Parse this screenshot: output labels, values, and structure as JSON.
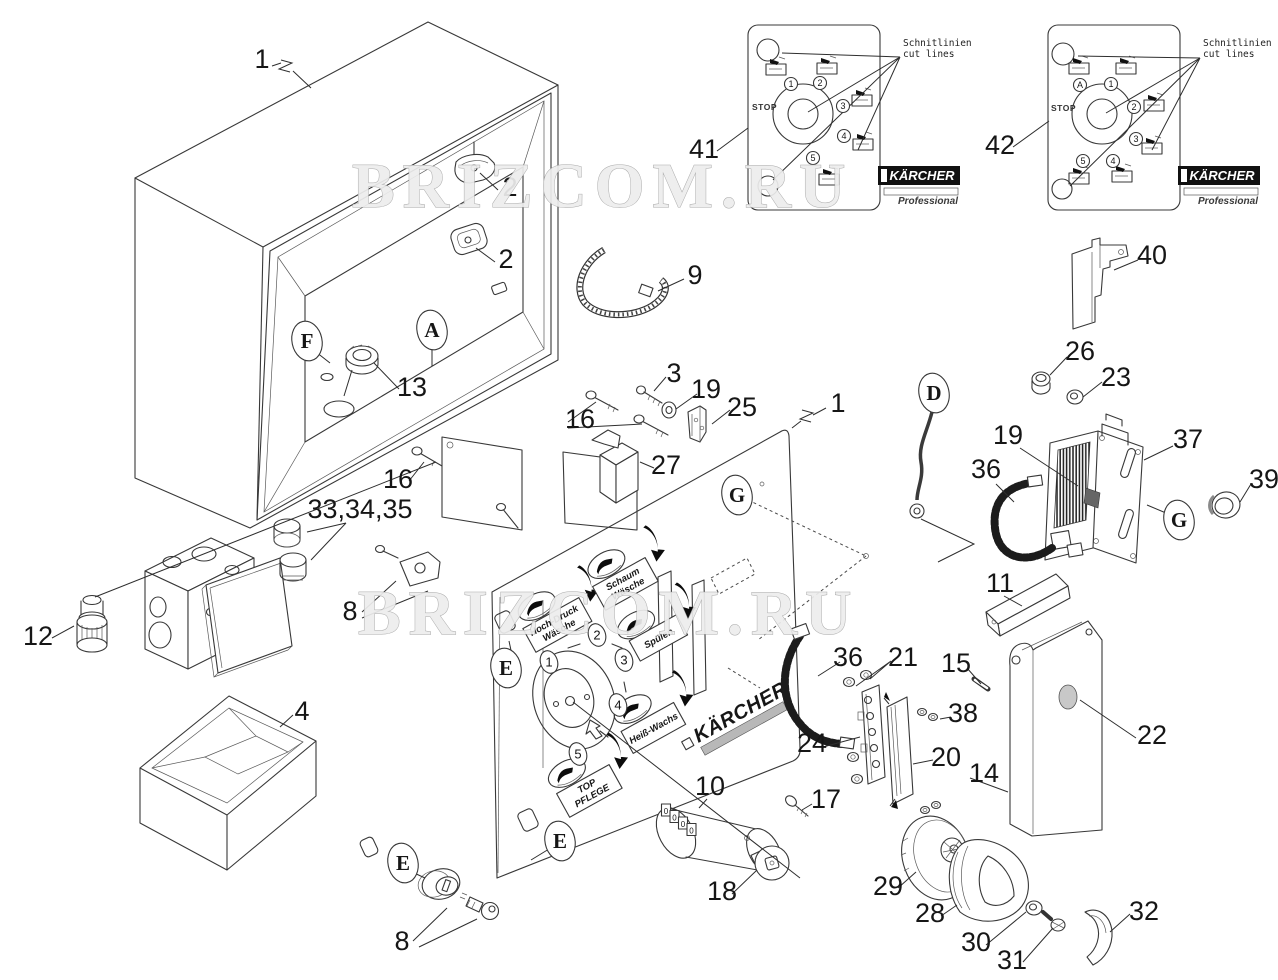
{
  "watermark": {
    "text": "BRIZCOM.RU",
    "instances": [
      {
        "x": 352,
        "y": 207
      },
      {
        "x": 358,
        "y": 634
      }
    ]
  },
  "callouts": [
    {
      "t": "1",
      "x": 262,
      "y": 68
    },
    {
      "t": "2",
      "x": 510,
      "y": 196
    },
    {
      "t": "2",
      "x": 506,
      "y": 268
    },
    {
      "t": "9",
      "x": 695,
      "y": 284
    },
    {
      "t": "13",
      "x": 412,
      "y": 396
    },
    {
      "t": "16",
      "x": 398,
      "y": 488
    },
    {
      "t": "33,34,35",
      "x": 360,
      "y": 518
    },
    {
      "t": "12",
      "x": 38,
      "y": 645
    },
    {
      "t": "8",
      "x": 350,
      "y": 620
    },
    {
      "t": "4",
      "x": 302,
      "y": 720
    },
    {
      "t": "16",
      "x": 580,
      "y": 428
    },
    {
      "t": "3",
      "x": 674,
      "y": 382
    },
    {
      "t": "19",
      "x": 706,
      "y": 398
    },
    {
      "t": "25",
      "x": 742,
      "y": 416
    },
    {
      "t": "27",
      "x": 666,
      "y": 474
    },
    {
      "t": "1",
      "x": 838,
      "y": 412
    },
    {
      "t": "41",
      "x": 704,
      "y": 158
    },
    {
      "t": "42",
      "x": 1000,
      "y": 154
    },
    {
      "t": "40",
      "x": 1152,
      "y": 264
    },
    {
      "t": "26",
      "x": 1080,
      "y": 360
    },
    {
      "t": "23",
      "x": 1116,
      "y": 386
    },
    {
      "t": "19",
      "x": 1008,
      "y": 444
    },
    {
      "t": "36",
      "x": 986,
      "y": 478
    },
    {
      "t": "37",
      "x": 1188,
      "y": 448
    },
    {
      "t": "39",
      "x": 1264,
      "y": 488
    },
    {
      "t": "11",
      "x": 1000,
      "y": 592
    },
    {
      "t": "15",
      "x": 956,
      "y": 672
    },
    {
      "t": "36",
      "x": 848,
      "y": 666
    },
    {
      "t": "21",
      "x": 903,
      "y": 666
    },
    {
      "t": "38",
      "x": 963,
      "y": 722
    },
    {
      "t": "24",
      "x": 812,
      "y": 752
    },
    {
      "t": "20",
      "x": 946,
      "y": 766
    },
    {
      "t": "14",
      "x": 984,
      "y": 782
    },
    {
      "t": "22",
      "x": 1152,
      "y": 744
    },
    {
      "t": "10",
      "x": 710,
      "y": 795
    },
    {
      "t": "17",
      "x": 826,
      "y": 808
    },
    {
      "t": "18",
      "x": 722,
      "y": 900
    },
    {
      "t": "29",
      "x": 888,
      "y": 895
    },
    {
      "t": "28",
      "x": 930,
      "y": 922
    },
    {
      "t": "30",
      "x": 976,
      "y": 951
    },
    {
      "t": "31",
      "x": 1012,
      "y": 969
    },
    {
      "t": "32",
      "x": 1144,
      "y": 920
    },
    {
      "t": "8",
      "x": 402,
      "y": 950
    }
  ],
  "ref_letters": [
    {
      "t": "F",
      "x": 307,
      "y": 341
    },
    {
      "t": "A",
      "x": 432,
      "y": 330
    },
    {
      "t": "D",
      "x": 934,
      "y": 393
    },
    {
      "t": "G",
      "x": 737,
      "y": 495
    },
    {
      "t": "G",
      "x": 1179,
      "y": 520
    },
    {
      "t": "E",
      "x": 506,
      "y": 668
    },
    {
      "t": "E",
      "x": 560,
      "y": 841
    },
    {
      "t": "E",
      "x": 403,
      "y": 863
    }
  ],
  "panel": {
    "brand": "KÄRCHER",
    "positions": [
      {
        "t": "1",
        "x": 549,
        "y": 662
      },
      {
        "t": "2",
        "x": 597,
        "y": 635
      },
      {
        "t": "3",
        "x": 624,
        "y": 660
      },
      {
        "t": "4",
        "x": 618,
        "y": 705
      },
      {
        "t": "5",
        "x": 578,
        "y": 754
      }
    ],
    "stickers": [
      {
        "line1": "Hoch-Druck",
        "line2": "Wäsche"
      },
      {
        "line1": "Schaum",
        "line2": "Wäsche"
      },
      {
        "line1": "Spülen",
        "line2": ""
      },
      {
        "line1": "Heiß-Wachs",
        "line2": ""
      },
      {
        "line1": "TOP",
        "line2": "PFLEGE"
      }
    ]
  },
  "decals": [
    {
      "id": "41",
      "stop": "STOP",
      "note1": "Schnitlinien",
      "note2": "cut lines",
      "brand": "KÄRCHER",
      "sub": "Professional",
      "positions": [
        {
          "t": "1",
          "x": 791,
          "y": 84
        },
        {
          "t": "2",
          "x": 820,
          "y": 83
        },
        {
          "t": "3",
          "x": 843,
          "y": 106
        },
        {
          "t": "4",
          "x": 844,
          "y": 136
        },
        {
          "t": "5",
          "x": 813,
          "y": 158
        }
      ]
    },
    {
      "id": "42",
      "stop": "STOP",
      "note1": "Schnitlinien",
      "note2": "cut lines",
      "brand": "KÄRCHER",
      "sub": "Professional",
      "positions": [
        {
          "t": "A",
          "x": 1080,
          "y": 85
        },
        {
          "t": "1",
          "x": 1111,
          "y": 84
        },
        {
          "t": "2",
          "x": 1134,
          "y": 107
        },
        {
          "t": "3",
          "x": 1136,
          "y": 139
        },
        {
          "t": "4",
          "x": 1113,
          "y": 161
        },
        {
          "t": "5",
          "x": 1083,
          "y": 161
        }
      ]
    }
  ],
  "counter": {
    "digits": [
      "0",
      "0",
      "0",
      "0"
    ]
  }
}
